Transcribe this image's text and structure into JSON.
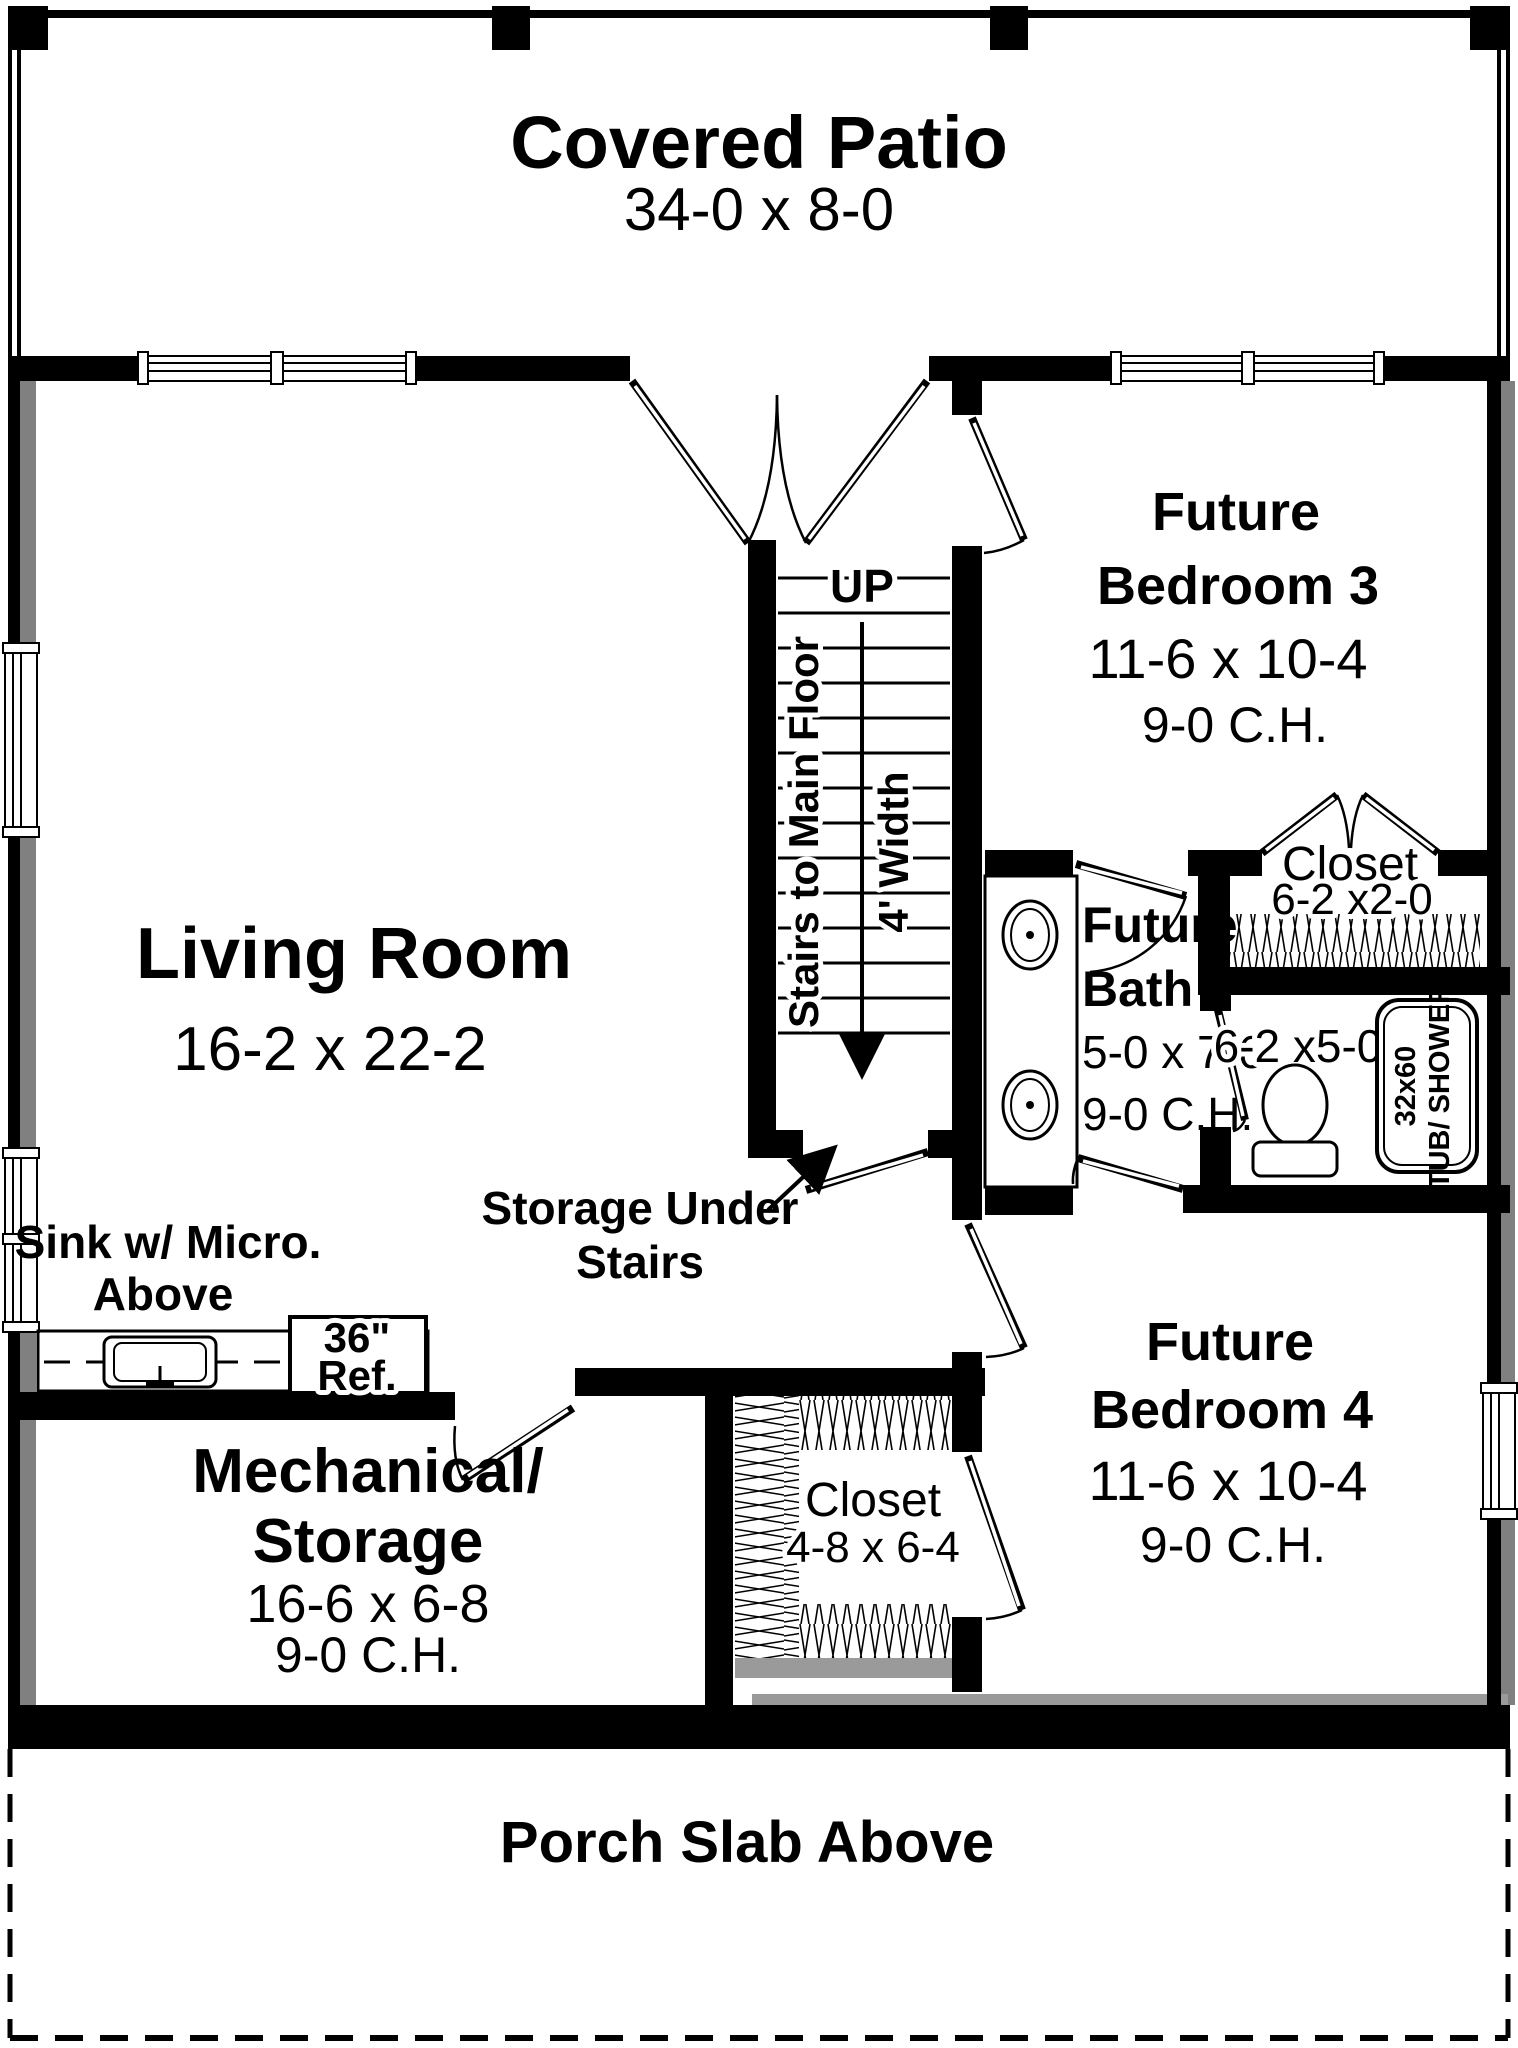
{
  "plan": {
    "covered_patio": {
      "name": "Covered Patio",
      "dims": "34-0 x 8-0"
    },
    "living_room": {
      "name": "Living Room",
      "dims": "16-2 x 22-2"
    },
    "bedroom3": {
      "name_line1": "Future",
      "name_line2": "Bedroom 3",
      "dims": "11-6 x 10-4",
      "ceiling": "9-0 C.H."
    },
    "bedroom4": {
      "name_line1": "Future",
      "name_line2": "Bedroom 4",
      "dims": "11-6 x 10-4",
      "ceiling": "9-0 C.H."
    },
    "bath": {
      "name_line1": "Future",
      "name_line2": "Bath",
      "dims": "5-0 x 7-6",
      "ceiling": "9-0 C.H."
    },
    "toilet_room": {
      "dims": "6-2 x5-0"
    },
    "tub": {
      "label_line1": "32x60",
      "label_line2": "TUB/ SHOWER"
    },
    "closet_bed3": {
      "name": "Closet",
      "dims": "6-2 x2-0"
    },
    "closet_bed4": {
      "name": "Closet",
      "dims": "4-8 x 6-4"
    },
    "mechanical": {
      "name_line1": "Mechanical/",
      "name_line2": "Storage",
      "dims": "16-6 x 6-8",
      "ceiling": "9-0 C.H."
    },
    "porch": {
      "name": "Porch Slab Above"
    },
    "stairs": {
      "up": "UP",
      "label": "Stairs to Main Floor",
      "width_label": "4' Width",
      "storage_line1": "Storage Under",
      "storage_line2": "Stairs"
    },
    "kitchenette": {
      "sink_line1": "Sink w/ Micro.",
      "sink_line2": "Above",
      "ref_line1": "36\"",
      "ref_line2": "Ref."
    }
  },
  "colors": {
    "wall": "#000000",
    "outer_shading": "#808080",
    "background": "#ffffff",
    "sill": "#9a9a9a"
  }
}
